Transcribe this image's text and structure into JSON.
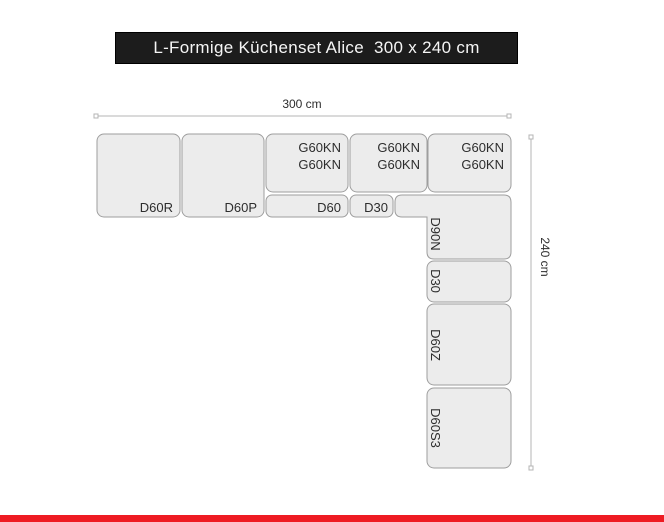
{
  "title": "L-Formige Küchenset Alice  300 x 240 cm",
  "dimensions": {
    "width": "300 cm",
    "height": "240 cm"
  },
  "cabinets": [
    {
      "code": "D60R"
    },
    {
      "code": "D60P"
    },
    {
      "code": "G60KN",
      "lines": 2
    },
    {
      "code": "D60"
    },
    {
      "code": "G60KN",
      "lines": 2
    },
    {
      "code": "D30"
    },
    {
      "code": "G60KN",
      "lines": 2
    },
    {
      "code": "D90N"
    },
    {
      "code": "D30"
    },
    {
      "code": "D60Z"
    },
    {
      "code": "D60S3"
    }
  ],
  "colors": {
    "banner_bg": "#1c1c1c",
    "banner_text": "#f5f5f5",
    "box_fill": "#ececec",
    "box_stroke": "#9e9e9e",
    "label_color": "#2d2d2d",
    "dim_line": "#b4b4b4",
    "red_bar": "#ee1b22"
  }
}
